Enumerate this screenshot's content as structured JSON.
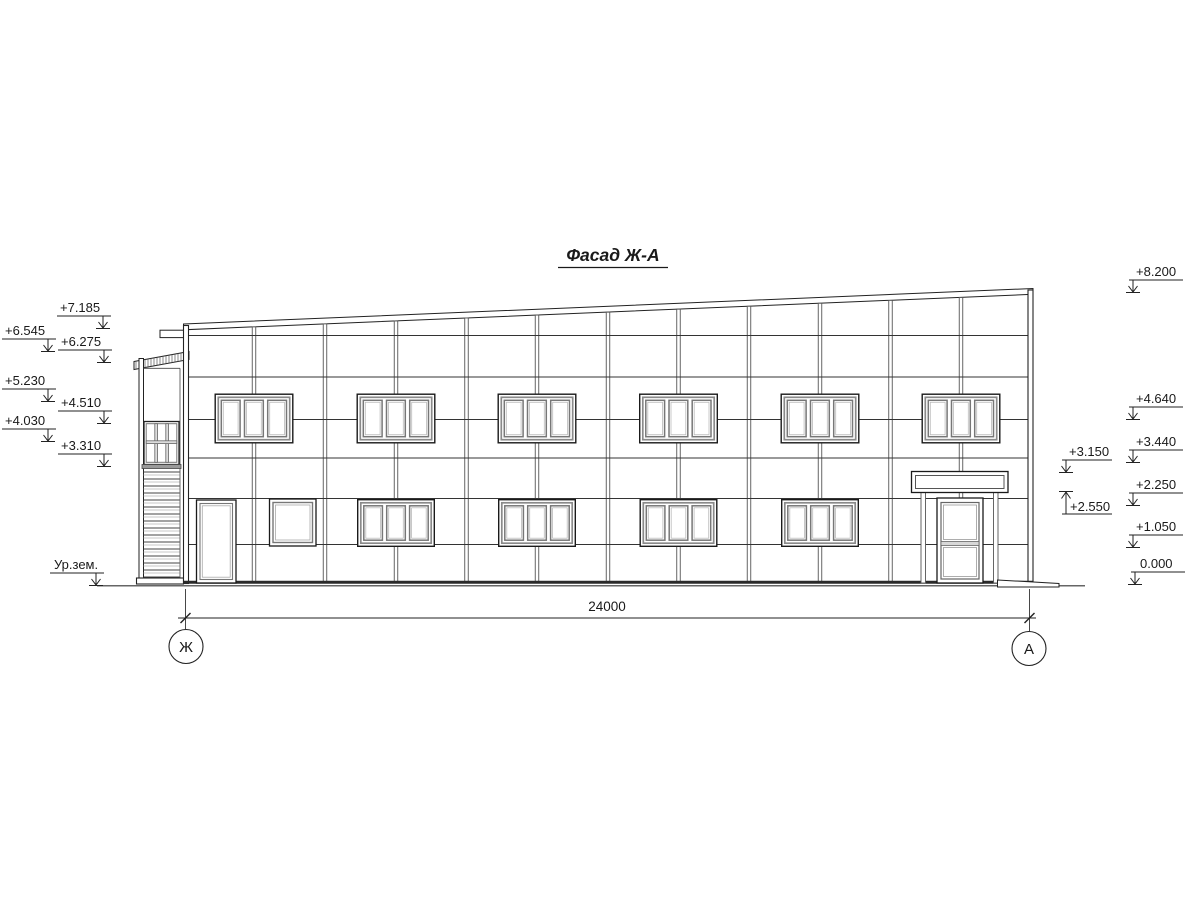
{
  "title": "Фасад Ж-А",
  "colors": {
    "background": "#ffffff",
    "line": "#1a1a1a",
    "frame_gray": "#8a8a8a"
  },
  "elevation_marks_left": [
    {
      "label": "+7.185"
    },
    {
      "label": "+6.545"
    },
    {
      "label": "+6.275"
    },
    {
      "label": "+5.230"
    },
    {
      "label": "+4.510"
    },
    {
      "label": "+4.030"
    },
    {
      "label": "+3.310"
    },
    {
      "label": "Ур.зем."
    }
  ],
  "elevation_marks_right": [
    {
      "label": "+8.200"
    },
    {
      "label": "+4.640"
    },
    {
      "label": "+3.440"
    },
    {
      "label": "+2.250"
    },
    {
      "label": "+1.050"
    },
    {
      "label": "0.000"
    }
  ],
  "entrance_marks": [
    {
      "label": "+3.150"
    },
    {
      "label": "+2.550"
    }
  ],
  "dimension": {
    "value": "24000"
  },
  "axes": {
    "left": "Ж",
    "right": "А"
  }
}
